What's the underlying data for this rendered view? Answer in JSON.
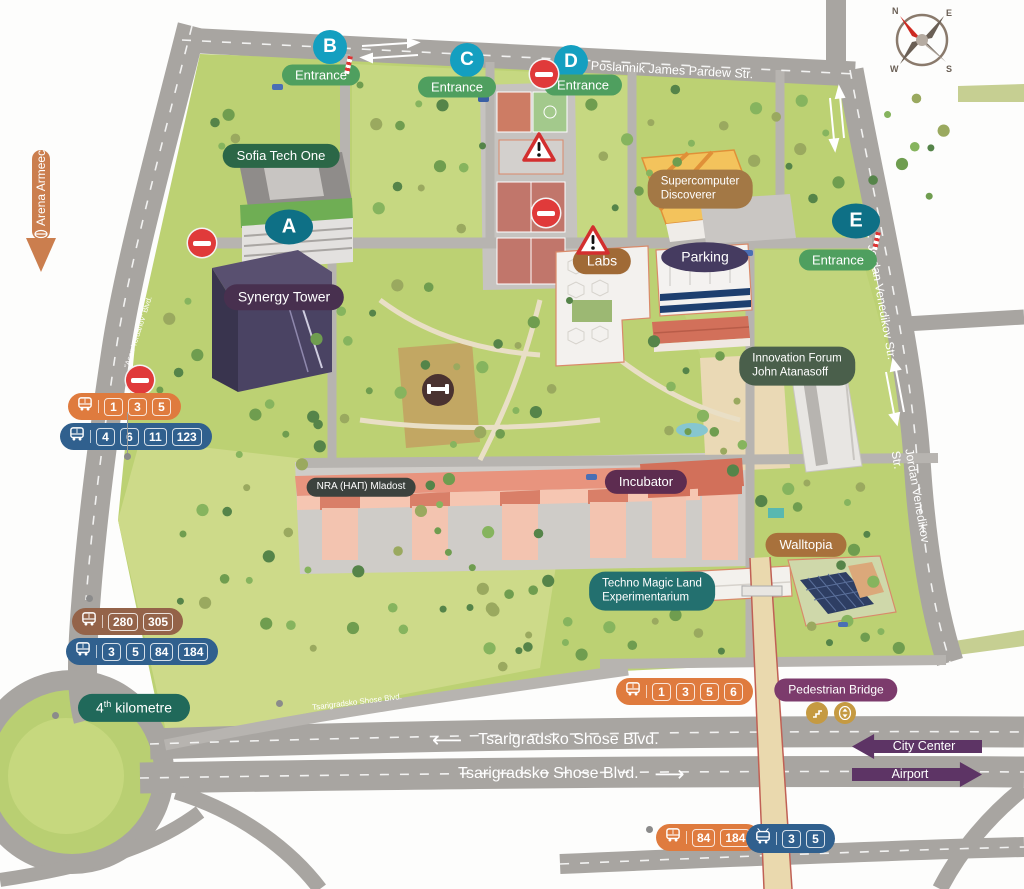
{
  "colors": {
    "teal_bright": "#149fc0",
    "teal_dark": "#0e7086",
    "green_entrance": "#4f9f5f",
    "green_dark": "#2b6747",
    "green_forest": "#4a5f4b",
    "nra_gray": "#3c423e",
    "teal_techno": "#23706f",
    "teal_km": "#20695a",
    "purple_synergy": "#48304f",
    "purple_parking": "#453b60",
    "purple_incubator": "#5d2c50",
    "purple_bridge": "#7c3b6c",
    "purple_route": "#5d3465",
    "brown_super": "#a37845",
    "brown_labs": "#a06a36",
    "brown_walltopia": "#a8713c",
    "brown_bus": "#946349",
    "orange_bus": "#df7b3e",
    "orange_arena": "#cb7e4e",
    "blue_bus": "#30608e",
    "red_sign": "#e03a3a"
  },
  "compass": {
    "n": "N",
    "e": "E",
    "s": "S",
    "w": "W"
  },
  "streets": {
    "pardew": "Poslannik James Pardew Str.",
    "venedikov_upper": "Jordan Venedikov Str.",
    "venedikov_lower": "Jordan Venedikov Str.",
    "asen_yordanov": "\"Asen Yordanov\" Blvd.",
    "tsarigradsko_small": "Tsarigradsko Shose Blvd.",
    "tsarigradsko_west": {
      "arrow": "⟵",
      "label": "Tsarigradsko Shose Blvd."
    },
    "tsarigradsko_east": {
      "label": "Tsarigradsko Shose Blvd.",
      "arrow": "⟶"
    }
  },
  "entrances": {
    "a": {
      "letter": "A"
    },
    "b": {
      "letter": "B",
      "label": "Entrance"
    },
    "c": {
      "letter": "C",
      "label": "Entrance"
    },
    "d": {
      "letter": "D",
      "label": "Entrance"
    },
    "e": {
      "letter": "E",
      "label": "Entrance"
    }
  },
  "places": {
    "sofia_tech_one": "Sofia Tech One",
    "synergy_tower": "Synergy Tower",
    "supercomputer": {
      "line1": "Supercomputer",
      "line2": "Discoverer"
    },
    "labs": "Labs",
    "parking": "Parking",
    "innovation_forum": {
      "line1": "Innovation Forum",
      "line2": "John Atanasoff"
    },
    "nra": "NRA (НАП) Mladost",
    "incubator": "Incubator",
    "walltopia": "Walltopia",
    "techno_magic_land": {
      "line1": "Techno Magic Land",
      "line2": "Experimentarium"
    },
    "pedestrian_bridge": "Pedestrian Bridge",
    "fourth_kilometre": {
      "prefix": "4",
      "sup": "th",
      "suffix": " kilometre"
    }
  },
  "directions": {
    "arena_armeec": "Arena Armeec",
    "city_center": "City Center",
    "airport": "Airport"
  },
  "bus_stops": {
    "west_orange": {
      "routes": [
        "1",
        "3",
        "5"
      ]
    },
    "west_blue": {
      "routes": [
        "4",
        "6",
        "11",
        "123"
      ]
    },
    "southwest_brown": {
      "routes": [
        "280",
        "305"
      ]
    },
    "southwest_blue": {
      "routes": [
        "3",
        "5",
        "84",
        "184"
      ]
    },
    "south_orange": {
      "routes": [
        "1",
        "3",
        "5",
        "6"
      ]
    },
    "bridge_orange": {
      "routes": [
        "84",
        "184"
      ]
    },
    "bridge_blue_tram": {
      "routes": [
        "3",
        "5"
      ]
    }
  }
}
